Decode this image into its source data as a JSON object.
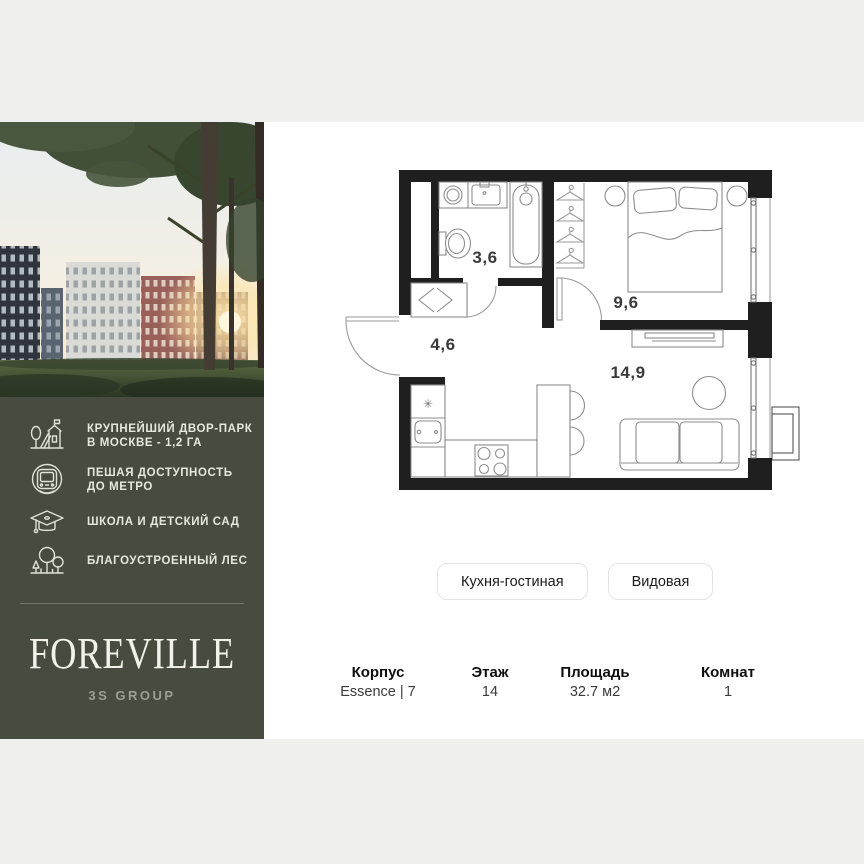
{
  "canvas": {
    "letterbox_color": "#efefee",
    "content_bg": "#ffffff"
  },
  "brand_panel": {
    "bg_color": "#474c3e",
    "logo": "FOREVILLE",
    "developer": "3S GROUP",
    "features": [
      {
        "icon": "park-icon",
        "lines": [
          "КРУПНЕЙШИЙ ДВОР-ПАРК",
          "В МОСКВЕ - 1,2 ГА"
        ]
      },
      {
        "icon": "metro-icon",
        "lines": [
          "ПЕШАЯ ДОСТУПНОСТЬ",
          "ДО МЕТРО"
        ]
      },
      {
        "icon": "graduation-cap-icon",
        "lines": [
          "ШКОЛА И ДЕТСКИЙ САД"
        ]
      },
      {
        "icon": "forest-icon",
        "lines": [
          "БЛАГОУСТРОЕННЫЙ ЛЕС"
        ]
      }
    ]
  },
  "floor_plan": {
    "wall_color": "#1f1f1f",
    "furniture_line_color": "#8d8d8d",
    "fridge_symbol": "✳",
    "rooms": [
      {
        "name": "bathroom",
        "area": "3,6"
      },
      {
        "name": "bedroom",
        "area": "9,6"
      },
      {
        "name": "hallway",
        "area": "4,6"
      },
      {
        "name": "kitchen-living-room",
        "area": "14,9"
      }
    ]
  },
  "tags": [
    {
      "label": "Кухня-гостиная"
    },
    {
      "label": "Видовая"
    }
  ],
  "details": [
    {
      "label": "Корпус",
      "value": "Essence | 7"
    },
    {
      "label": "Этаж",
      "value": "14"
    },
    {
      "label": "Площадь",
      "value": "32.7 м2"
    },
    {
      "label": "Комнат",
      "value": "1"
    }
  ]
}
